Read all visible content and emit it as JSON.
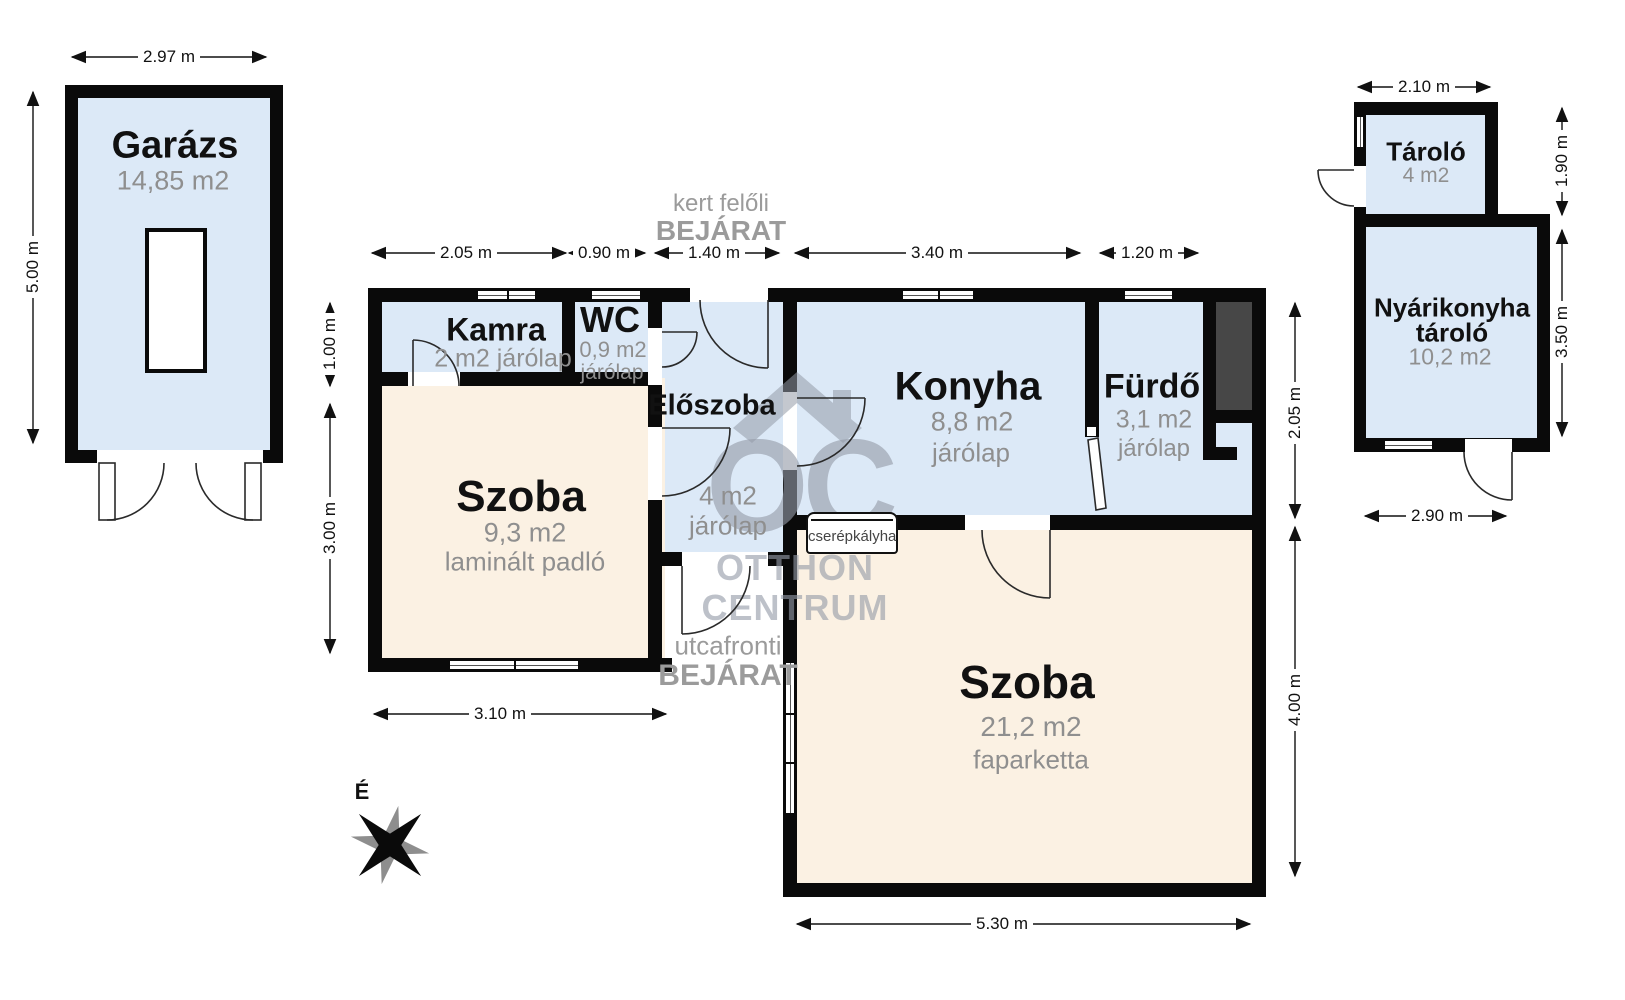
{
  "colors": {
    "room_blue": "#dce9f7",
    "room_cream": "#fbf1e3",
    "wall_black": "#0a0a0a",
    "chimney_gray": "#474747",
    "sub_text_gray": "#8f8f8f",
    "entrance_gray": "#9b9b9b",
    "watermark_gray": "#949BA8"
  },
  "garage": {
    "name": "Garázs",
    "area": "14,85 m2",
    "dim_width": "2.97 m",
    "dim_height": "5.00 m"
  },
  "house": {
    "entrance_garden_line1": "kert felőli",
    "entrance_garden_line2": "BEJÁRAT",
    "entrance_street_line1": "utcafronti",
    "entrance_street_line2": "BEJÁRAT",
    "rooms": {
      "kamra": {
        "name": "Kamra",
        "area": "2 m2 járólap"
      },
      "wc": {
        "name": "WC",
        "area": "0,9 m2",
        "floor": "járólap"
      },
      "eloszoba": {
        "name": "Előszoba",
        "area": "4 m2",
        "floor": "járólap"
      },
      "konyha": {
        "name": "Konyha",
        "area": "8,8 m2",
        "floor": "járólap"
      },
      "furdo": {
        "name": "Fürdő",
        "area": "3,1 m2",
        "floor": "járólap"
      },
      "szoba1": {
        "name": "Szoba",
        "area": "9,3 m2",
        "floor": "laminált padló"
      },
      "szoba2": {
        "name": "Szoba",
        "area": "21,2 m2",
        "floor": "faparketta"
      }
    },
    "stove_label": "cserépkályha",
    "dims": {
      "top": [
        "2.05 m",
        "0.90 m",
        "1.40 m",
        "3.40 m",
        "1.20 m"
      ],
      "left": [
        "1.00 m",
        "3.00 m"
      ],
      "right": [
        "2.05 m",
        "4.00 m"
      ],
      "bottom_left": "3.10 m",
      "bottom_right": "5.30 m"
    }
  },
  "outbuilding": {
    "tarolo": {
      "name": "Tároló",
      "area": "4 m2"
    },
    "nyarikonyha": {
      "name_line1": "Nyárikonyha",
      "name_line2": "tároló",
      "area": "10,2 m2"
    },
    "dims": {
      "top": "2.10 m",
      "right_upper": "1.90 m",
      "right_lower": "3.50 m",
      "bottom": "2.90 m"
    }
  },
  "compass_label": "É",
  "watermark": {
    "monogram": "OC",
    "line1": "OTTHON",
    "line2": "CENTRUM"
  }
}
